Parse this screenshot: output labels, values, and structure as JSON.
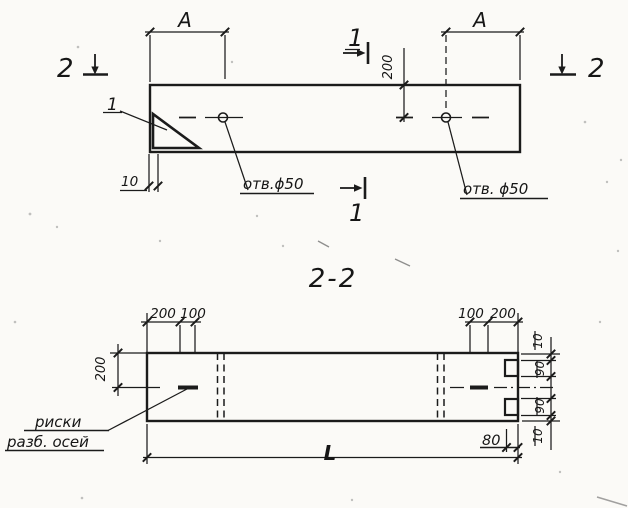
{
  "colors": {
    "ink": "#1b1b1b",
    "paper": "#fbfaf7"
  },
  "plan": {
    "marker2_left": "2",
    "marker2_right": "2",
    "marker1_top": "1",
    "marker1_bottom": "1",
    "dim_a_left": "A",
    "dim_a_right": "A",
    "dim_200": "200",
    "dim_10": "10",
    "detail_label": "1",
    "hole_label_left": "отв.ϕ50",
    "hole_label_right": "отв. ϕ50"
  },
  "section": {
    "title": "2-2",
    "dims_top_left": [
      "200",
      "100"
    ],
    "dims_top_right": [
      "100",
      "200"
    ],
    "dim_side_left": "200",
    "dims_side_right": [
      "10",
      "90",
      "90",
      "10"
    ],
    "dim_notch_depth": "80",
    "dim_total_length": "L",
    "axis_note": [
      "риски",
      "разб. осей"
    ]
  }
}
